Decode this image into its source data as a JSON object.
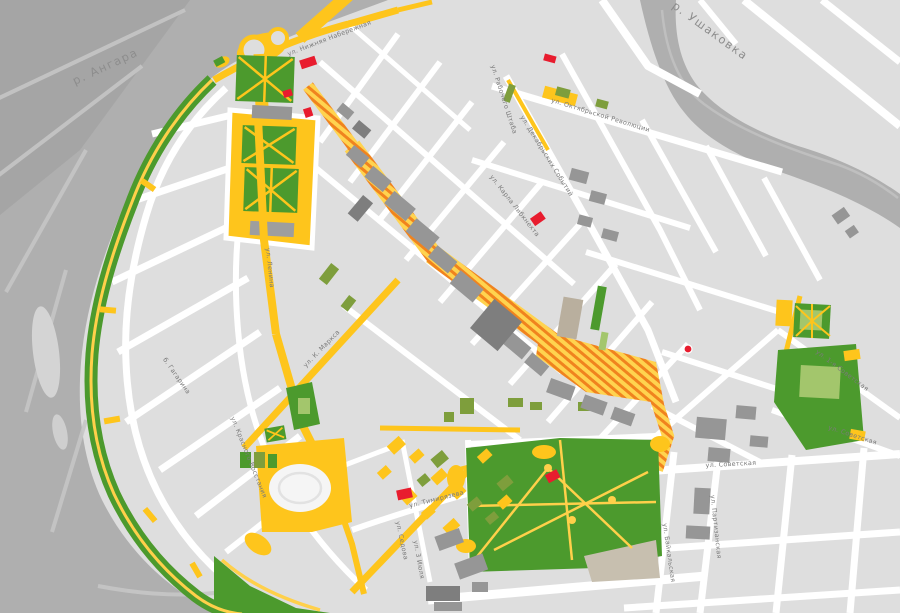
{
  "title": "Схема центра города (Иркутск)",
  "colors": {
    "city_bg": "#dedede",
    "water": "#afafaf",
    "water_dark": "#a2a2a2",
    "water_streak": "#c6c6c6",
    "street_white": "#ffffff",
    "road_yellow": "#fec51c",
    "path_yellow": "#ffd04a",
    "park_green": "#4c9a2d",
    "olive_green": "#7e9e3c",
    "light_green": "#a3c66c",
    "hatch_orange": "#f0831e",
    "hatch_yellow": "#ffd34f",
    "building_gray": "#969696",
    "building_dark": "#7e7e7e",
    "building_tan": "#b9af9e",
    "landmark_red": "#e81c2e"
  },
  "map": {
    "rivers": [
      "р. Ангара",
      "р. Ушаковка"
    ],
    "labels": [
      {
        "text": "р. Ангара",
        "x": 107,
        "y": 70,
        "rot": -25,
        "type": "river"
      },
      {
        "text": "р. Ушаковка",
        "x": 708,
        "y": 34,
        "rot": 36,
        "type": "river"
      },
      {
        "text": "ул. Нижняя Набережная",
        "x": 330,
        "y": 40,
        "rot": -21,
        "type": "street"
      },
      {
        "text": "ул. Октябрьской Революции",
        "x": 600,
        "y": 117,
        "rot": 17,
        "type": "street"
      },
      {
        "text": "ул. Декабрьских Событий",
        "x": 545,
        "y": 157,
        "rot": 58,
        "type": "street"
      },
      {
        "text": "ул. Рабочего Штаба",
        "x": 502,
        "y": 100,
        "rot": 72,
        "type": "street"
      },
      {
        "text": "ул. Карла Либкнехта",
        "x": 513,
        "y": 207,
        "rot": 52,
        "type": "street"
      },
      {
        "text": "ул. Ленина",
        "x": 268,
        "y": 268,
        "rot": 84,
        "type": "street"
      },
      {
        "text": "ул. К. Маркса",
        "x": 323,
        "y": 350,
        "rot": -46,
        "type": "street"
      },
      {
        "text": "б. Гагарина",
        "x": 175,
        "y": 377,
        "rot": 55,
        "type": "street"
      },
      {
        "text": "ул. Красного Восстания",
        "x": 247,
        "y": 458,
        "rot": 68,
        "type": "street"
      },
      {
        "text": "ул. Тимирязева",
        "x": 437,
        "y": 501,
        "rot": -14,
        "type": "street"
      },
      {
        "text": "ул. Седова",
        "x": 400,
        "y": 541,
        "rot": 78,
        "type": "street"
      },
      {
        "text": "ул. 3 Июля",
        "x": 417,
        "y": 560,
        "rot": 80,
        "type": "street"
      },
      {
        "text": "ул. Советская",
        "x": 731,
        "y": 466,
        "rot": -3,
        "type": "street"
      },
      {
        "text": "ул. Советская",
        "x": 852,
        "y": 437,
        "rot": 18,
        "type": "street"
      },
      {
        "text": "ул. 1-я Советская",
        "x": 841,
        "y": 372,
        "rot": 37,
        "type": "street"
      },
      {
        "text": "ул. Байкальская",
        "x": 667,
        "y": 553,
        "rot": 82,
        "type": "street"
      },
      {
        "text": "ул. Партизанская",
        "x": 714,
        "y": 527,
        "rot": 84,
        "type": "street"
      }
    ]
  }
}
